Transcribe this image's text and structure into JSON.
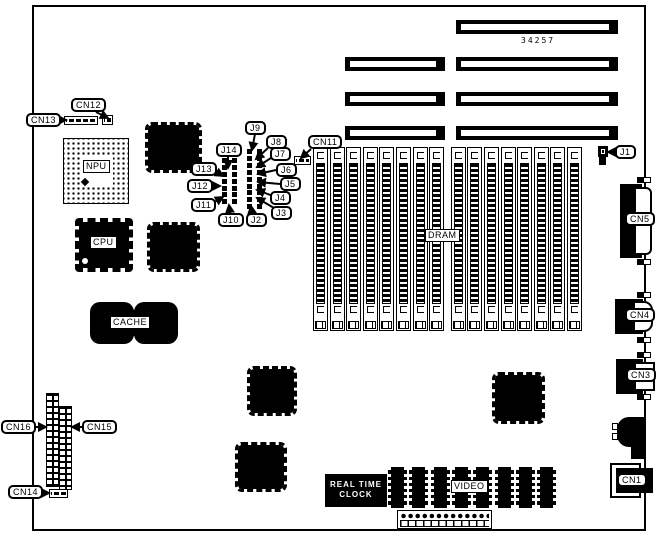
{
  "figure": {
    "part_number": "34257",
    "type": "motherboard component location diagram"
  },
  "labels": {
    "cn1": "CN1",
    "cn3": "CN3",
    "cn4": "CN4",
    "cn5": "CN5",
    "cn11": "CN11",
    "cn12": "CN12",
    "cn13": "CN13",
    "cn14": "CN14",
    "cn15": "CN15",
    "cn16": "CN16",
    "j1": "J1",
    "j2": "J2",
    "j3": "J3",
    "j4": "J4",
    "j5": "J5",
    "j6": "J6",
    "j7": "J7",
    "j8": "J8",
    "j9": "J9",
    "j10": "J10",
    "j11": "J11",
    "j12": "J12",
    "j13": "J13",
    "j14": "J14",
    "npu": "NPU",
    "cpu": "CPU",
    "cache": "CACHE",
    "dram": "DRAM",
    "video": "VIDEO",
    "rtc_line1": "REAL TIME",
    "rtc_line2": "CLOCK"
  },
  "dram": {
    "slot_count": 16
  },
  "video": {
    "chip_count": 8
  },
  "jumper_blocks": {
    "left_rows": 8,
    "right_rows": 9
  },
  "expansion_slots": {
    "count": 7
  },
  "colors": {
    "ink": "#000000",
    "paper": "#ffffff"
  }
}
